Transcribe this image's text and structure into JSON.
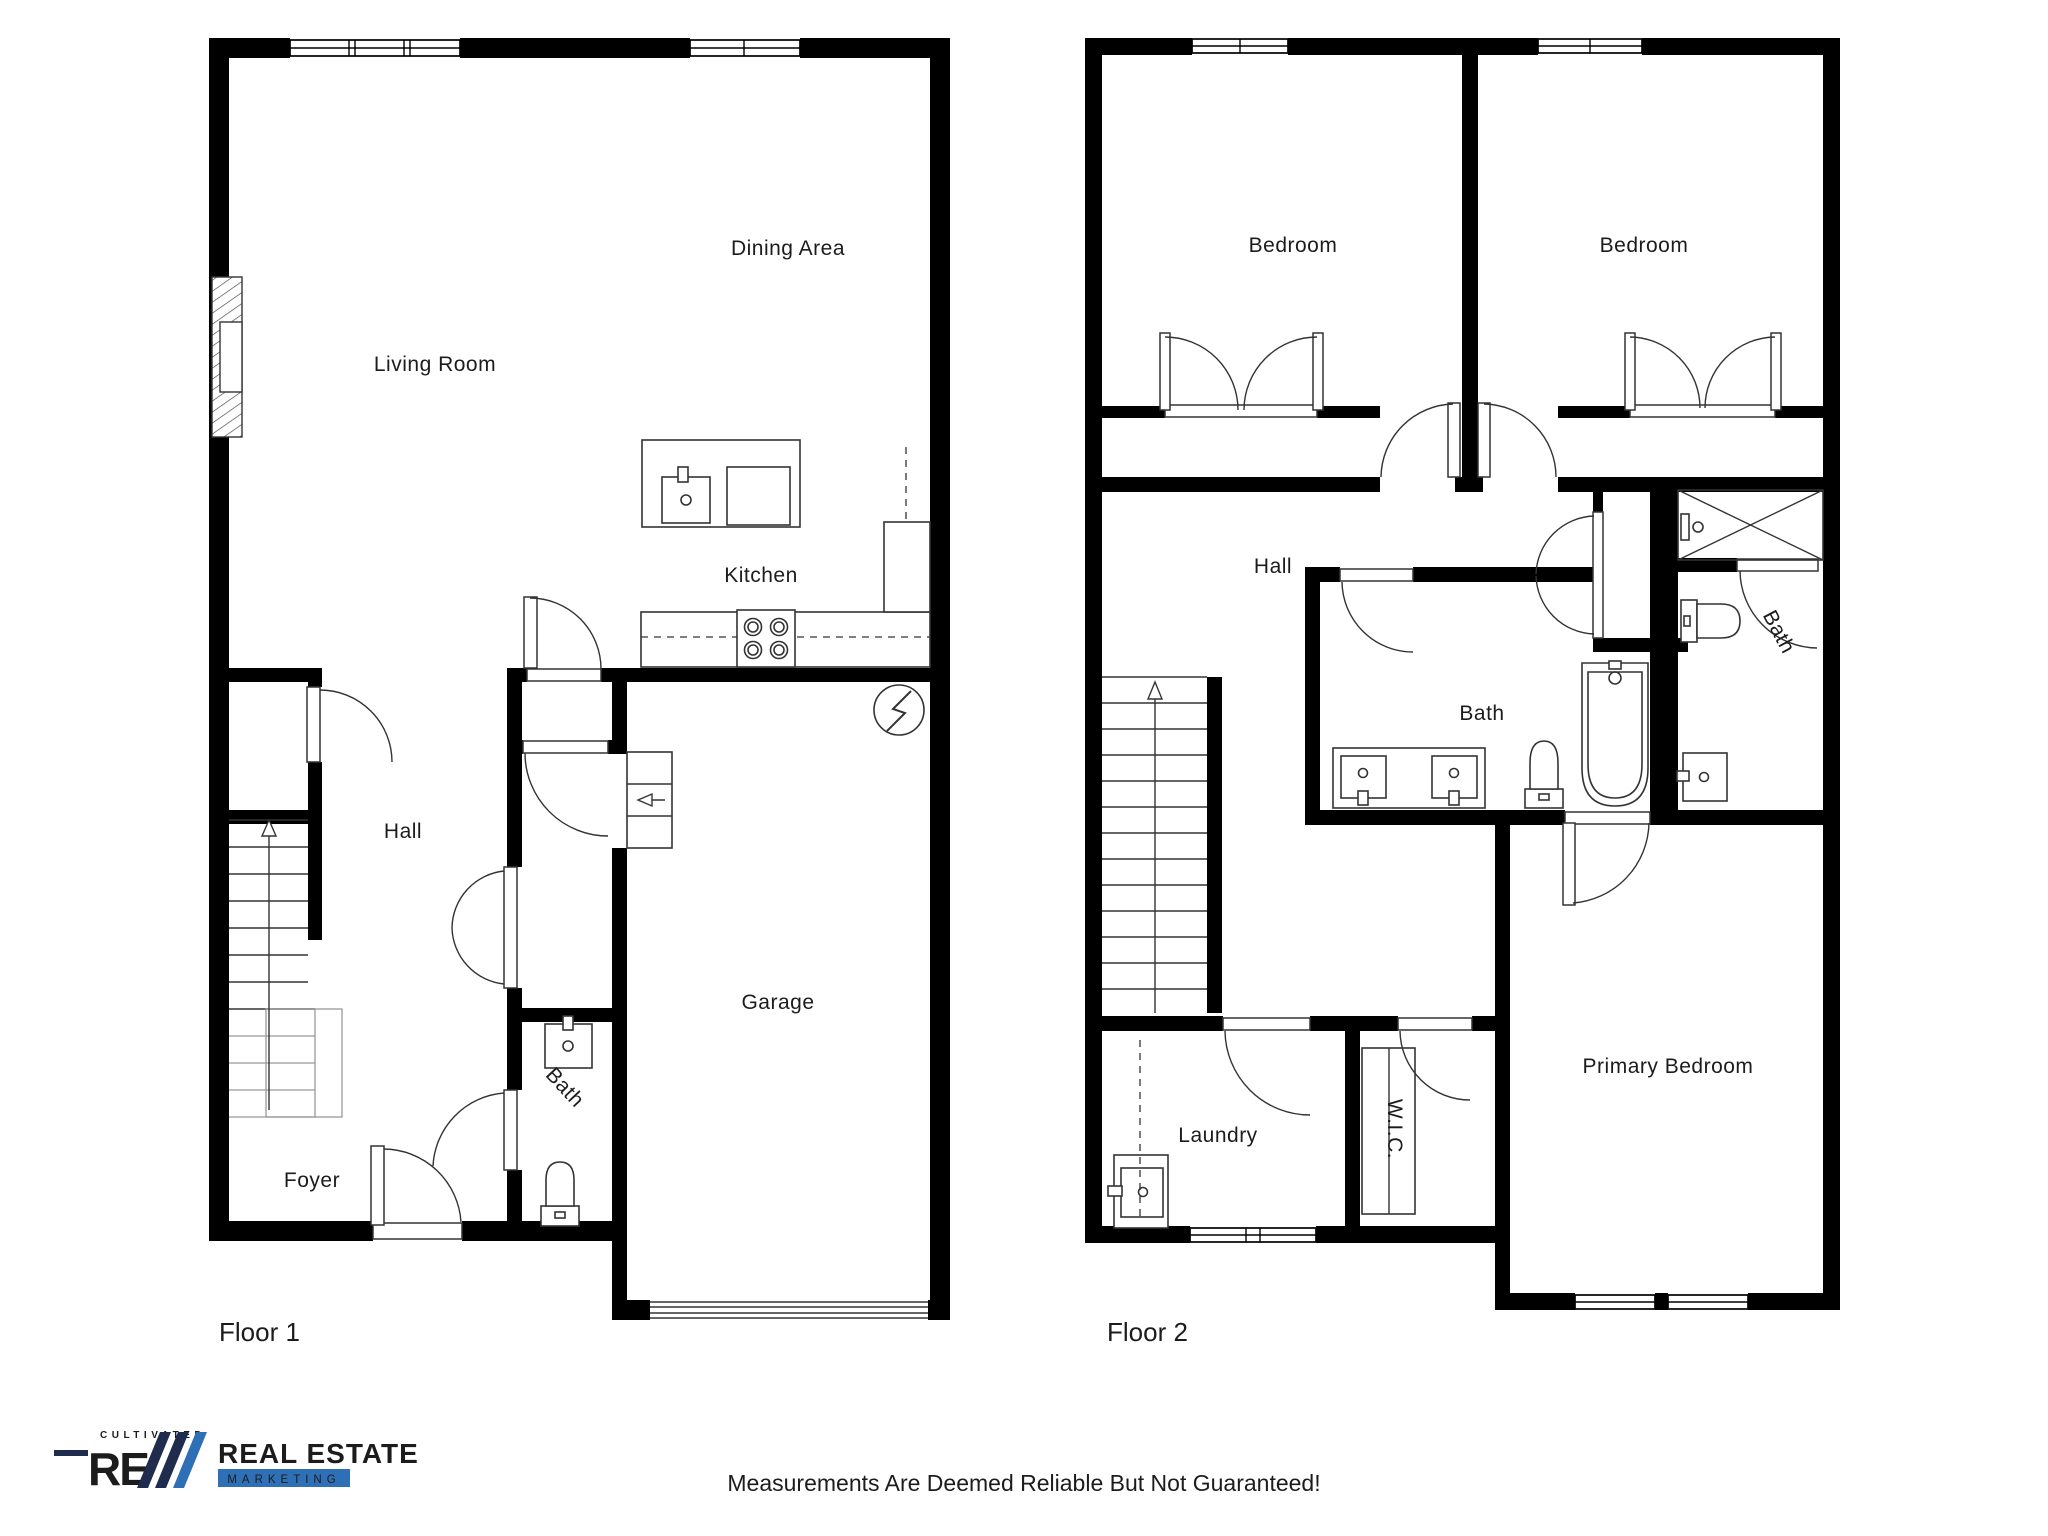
{
  "floor1": {
    "label": "Floor 1",
    "rooms": [
      {
        "label": "Living Room"
      },
      {
        "label": "Dining Area"
      },
      {
        "label": "Kitchen"
      },
      {
        "label": "Hall"
      },
      {
        "label": "Bath"
      },
      {
        "label": "Foyer"
      },
      {
        "label": "Garage"
      }
    ]
  },
  "floor2": {
    "label": "Floor 2",
    "rooms": [
      {
        "label": "Bedroom"
      },
      {
        "label": "Bedroom"
      },
      {
        "label": "Hall"
      },
      {
        "label": "Bath"
      },
      {
        "label": "Bath"
      },
      {
        "label": "Laundry"
      },
      {
        "label": "W.I.C."
      },
      {
        "label": "Primary Bedroom"
      }
    ]
  },
  "footer": {
    "disclaimer": "Measurements Are Deemed Reliable But Not Guaranteed!"
  },
  "logo": {
    "tagline": "CULTIVATED",
    "monogram": "RE",
    "name": "REAL ESTATE",
    "subname": "MARKETING",
    "navy": "#1f2c4e",
    "blue": "#2e6fb6"
  }
}
